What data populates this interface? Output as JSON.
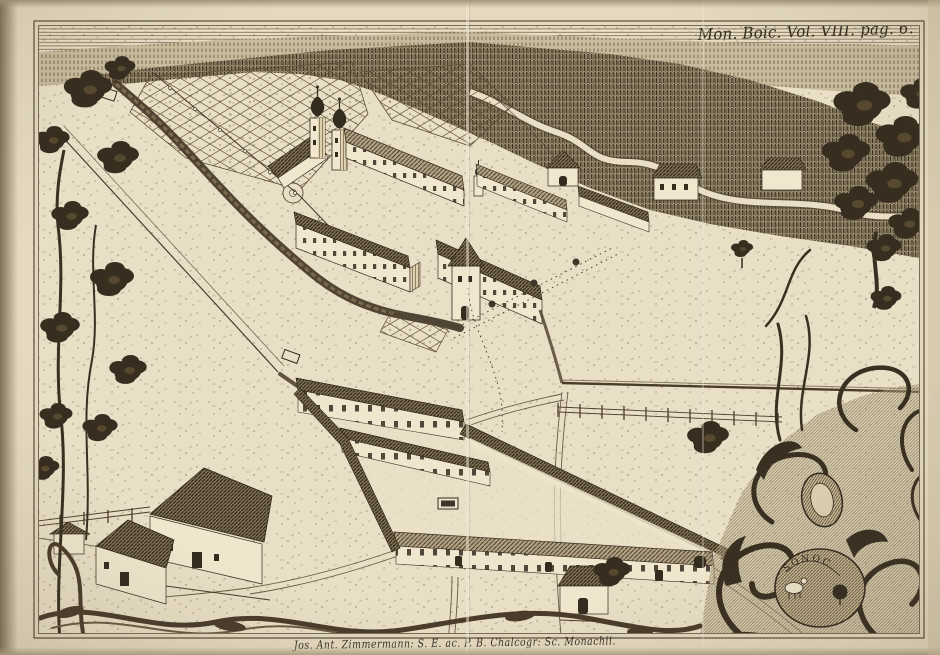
{
  "engraving": {
    "plate_inscription": "Mon. Boic. Vol. VIII. pag. 6.",
    "engraver_caption": "Jos. Ant. Zimmermann: S. E. ac. P. B. Chalcogr: Sc. Monachii.",
    "cartouche_letters": "SONOC"
  },
  "colors": {
    "paper": "#e4d9bf",
    "plate_paper": "#e9dfc6",
    "ink_dark": "#352c20",
    "ink_mid": "#5a4a36",
    "forest": "#9c8f71",
    "edge_shadow": "#7e7156"
  }
}
